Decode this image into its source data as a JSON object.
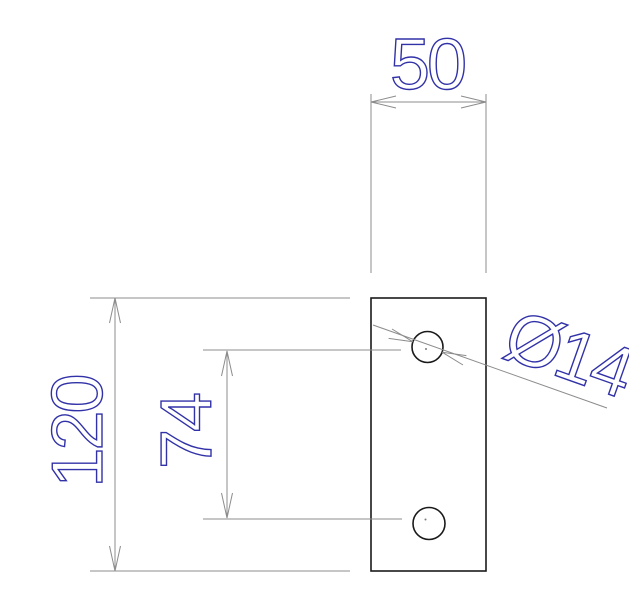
{
  "drawing": {
    "type": "2D technical drawing",
    "part": {
      "description": "rectangular plate, front view, with two through holes on the vertical centerline",
      "hole_count": 2
    },
    "dims": {
      "width": "50",
      "height": "120",
      "spacing": "74",
      "diameter": "Ø14"
    },
    "colors": {
      "background": "#ffffff",
      "part_outline": "#1a1a1a",
      "dimension_lines": "#8c8c8c",
      "dimension_text": "#3232a8"
    }
  }
}
